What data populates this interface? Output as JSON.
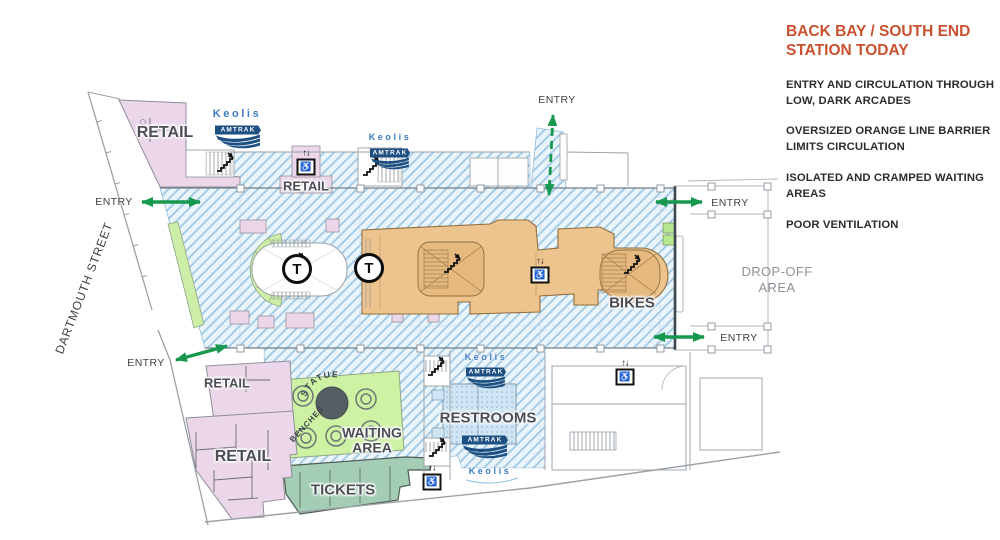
{
  "colors": {
    "accent_title": "#C8512F",
    "entry_green": "#17984f",
    "keolis_blue": "#3B7CC1",
    "amtrak_navy": "#1E4F82",
    "orange_barrier": "#EDC48E",
    "retail_pink": "#EBD7E9",
    "waiting_green": "#CDF2A3",
    "tickets_teal": "#A3CDB4",
    "restroom_blue": "#CFE5F4"
  },
  "sidebar": {
    "title_line1": "BACK BAY / SOUTH END",
    "title_line2": "STATION TODAY",
    "bullets": [
      "ENTRY AND CIRCULATION THROUGH LOW, DARK ARCADES",
      "OVERSIZED ORANGE LINE BARRIER LIMITS CIRCULATION",
      "ISOLATED AND CRAMPED WAITING AREAS",
      "POOR VENTILATION"
    ]
  },
  "plan": {
    "street": "DARTMOUTH STREET",
    "dropoff_line1": "DROP-OFF",
    "dropoff_line2": "AREA",
    "entry": "ENTRY",
    "retail": "RETAIL",
    "bikes": "BIKES",
    "restrooms": "RESTROOMS",
    "waiting_line1": "WAITING",
    "waiting_line2": "AREA",
    "tickets": "TICKETS",
    "statue": "STATUE",
    "benches": "BENCHES",
    "keolis": "Keolis",
    "amtrak": "AMTRAK",
    "t": "T",
    "elevator_arrows": "↑↓",
    "wheelchair": "♿"
  }
}
